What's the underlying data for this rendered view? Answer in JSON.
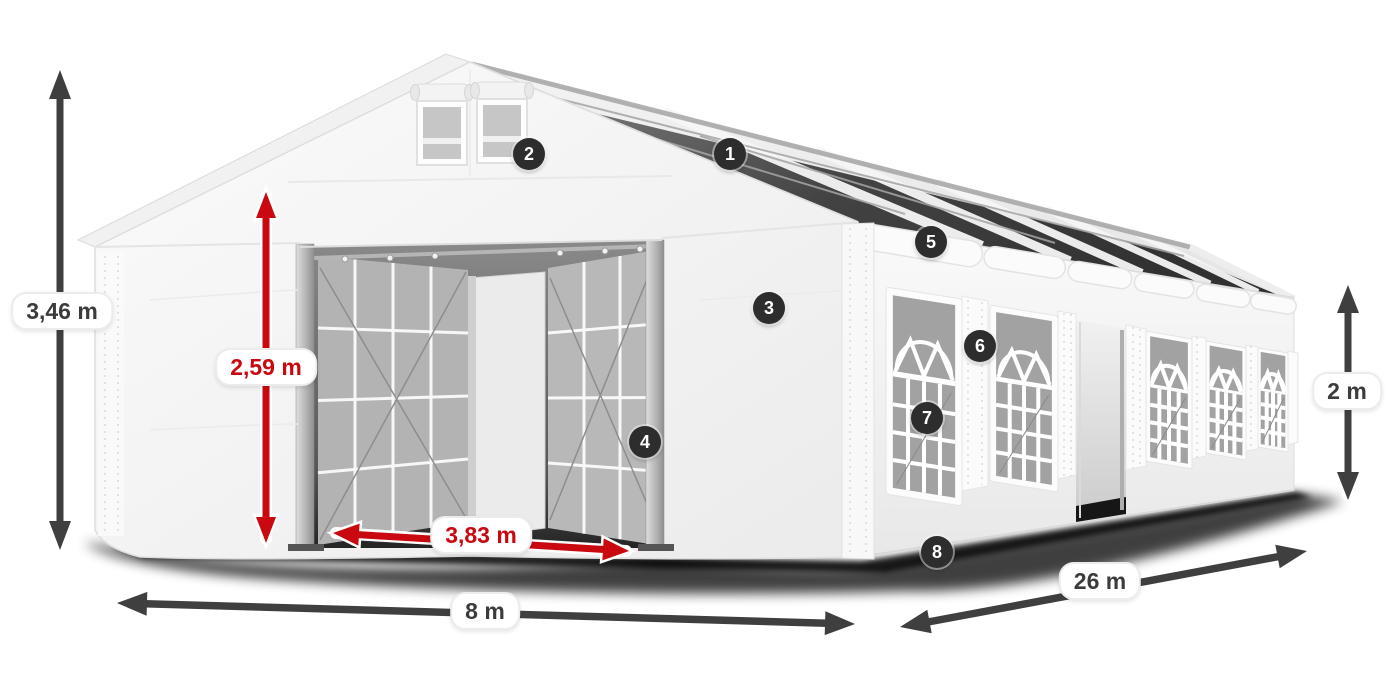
{
  "page": {
    "type": "product-dimension-diagram",
    "subject": "White marquee party tent 8 x 26 m with numbered feature callouts"
  },
  "dimensions": [
    {
      "id": "total-height",
      "label": "3,46 m",
      "style": "dark"
    },
    {
      "id": "entrance-height",
      "label": "2,59 m",
      "style": "red"
    },
    {
      "id": "entrance-width",
      "label": "3,83 m",
      "style": "red"
    },
    {
      "id": "end-width",
      "label": "8 m",
      "style": "dark"
    },
    {
      "id": "side-length",
      "label": "26 m",
      "style": "dark"
    },
    {
      "id": "side-wall-height",
      "label": "2 m",
      "style": "dark"
    }
  ],
  "callouts": [
    {
      "number": "1"
    },
    {
      "number": "2"
    },
    {
      "number": "3"
    },
    {
      "number": "4"
    },
    {
      "number": "5"
    },
    {
      "number": "6"
    },
    {
      "number": "7"
    },
    {
      "number": "8"
    }
  ],
  "colors": {
    "dimension_red": "#c9080f",
    "dimension_dark": "#3f3f3f",
    "badge_background": "#2d2d2d",
    "badge_text": "#ffffff",
    "label_background": "#ffffff",
    "tent_fabric": "#f5f5f5",
    "window_pane": "#a2a2a2",
    "roof_glazing": "#2a2a2a"
  }
}
